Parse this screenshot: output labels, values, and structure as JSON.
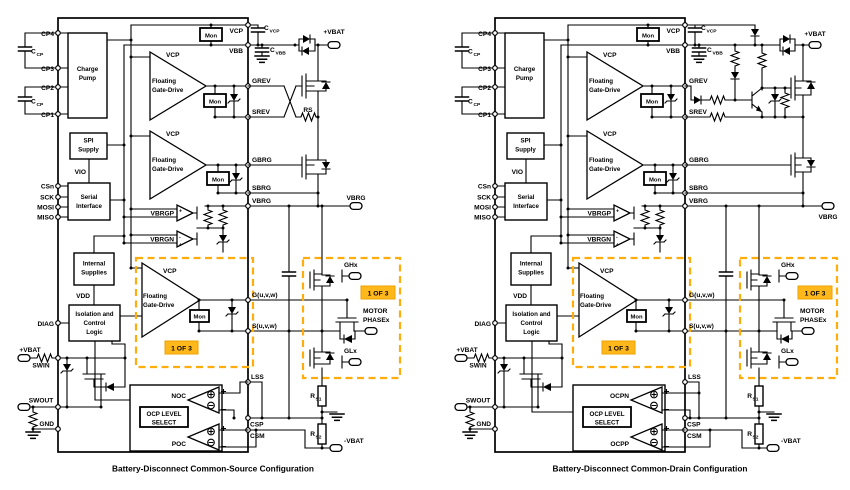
{
  "colors": {
    "accent_orange": "#FFAD0D",
    "badge_orange": "#FFB81C"
  },
  "common": {
    "pins_left": {
      "cp4": "CP4",
      "cp3": "CP3",
      "cp2": "CP2",
      "cp1": "CP1",
      "csn": "CSn",
      "sck": "SCK",
      "mosi": "MOSI",
      "miso": "MISO",
      "diag": "DIAG",
      "swin": "SWIN",
      "swout": "SWOUT",
      "gnd": "GND"
    },
    "pins_right": {
      "vcp": "VCP",
      "vbb": "VBB",
      "grev": "GREV",
      "srev": "SREV",
      "gbrg": "GBRG",
      "sbrg": "SBRG",
      "vbrg": "VBRG",
      "g": "G(u,v,w)",
      "s": "S(u,v,w)",
      "lss": "LSS",
      "csp": "CSP",
      "csm": "CSM"
    },
    "blocks": {
      "charge_pump_l1": "Charge",
      "charge_pump_l2": "Pump",
      "spi_l1": "SPI",
      "spi_l2": "Supply",
      "serial_l1": "Serial",
      "serial_l2": "Interface",
      "internal_l1": "Internal",
      "internal_l2": "Supplies",
      "iso_l1": "Isolation and",
      "iso_l2": "Control",
      "iso_l3": "Logic",
      "ocp_l1": "OCP LEVEL",
      "ocp_l2": "SELECT"
    },
    "nets": {
      "vio": "VIO",
      "vdd": "VDD",
      "vcp": "VCP",
      "vbrgp": "VBRGP",
      "vbrgn": "VBRGN"
    },
    "amp": {
      "fgd_l1": "Floating",
      "fgd_l2": "Gate-Drive",
      "mon": "Mon"
    },
    "sym": {
      "cap": "C",
      "sub_cp": "CP",
      "sub_vcp": "VCP",
      "sub_vbb": "VBB",
      "res": "R",
      "sub_s1": "S1",
      "sub_s2": "S2",
      "plus": "+",
      "minus": "-"
    },
    "ext": {
      "vbat_pos": "+VBAT",
      "vbat_neg": "-VBAT",
      "vbrg": "VBRG",
      "ghx": "GHx",
      "glx": "GLx",
      "motor_l1": "MOTOR",
      "motor_l2": "PHASEx",
      "one_of_three": "1 OF 3"
    }
  },
  "left": {
    "rs": "RS",
    "noc": "NOC",
    "poc": "POC",
    "caption": "Battery-Disconnect Common-Source Configuration"
  },
  "right": {
    "ocpn": "OCPN",
    "ocpp": "OCPP",
    "caption": "Battery-Disconnect Common-Drain Configuration"
  }
}
